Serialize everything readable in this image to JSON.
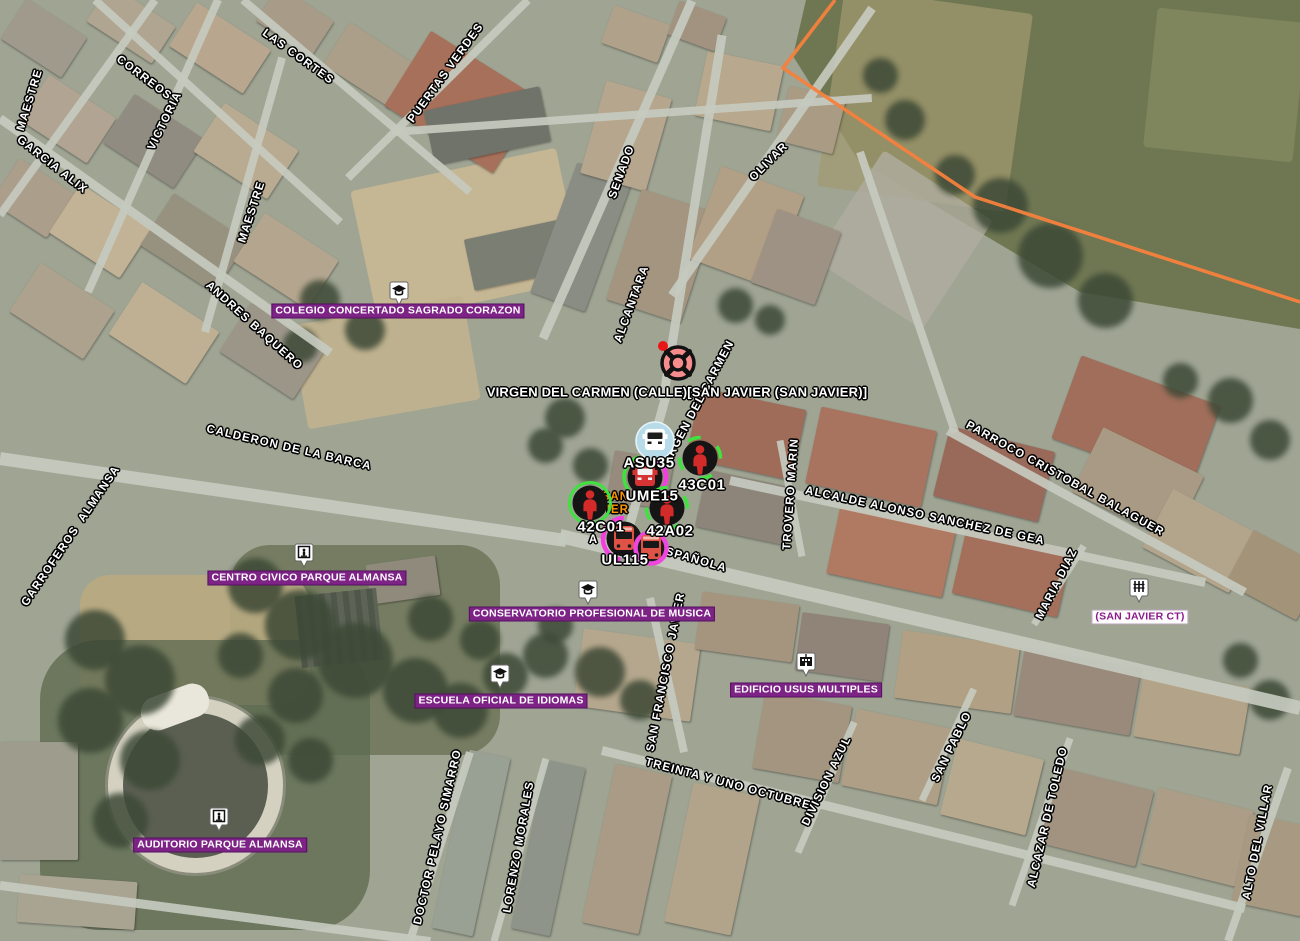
{
  "map": {
    "incident": {
      "label": "VIRGEN DEL CARMEN (CALLE)[SAN JAVIER (SAN JAVIER)]",
      "icon": "crosshair-target-icon",
      "x": 678,
      "y": 363,
      "label_x": 677,
      "label_y": 392
    },
    "street_labels": [
      {
        "text": "MAESTRE",
        "x": 30,
        "y": 100,
        "rot": -73
      },
      {
        "text": "CORREOS",
        "x": 144,
        "y": 78,
        "rot": 37
      },
      {
        "text": "VICTORIA",
        "x": 165,
        "y": 121,
        "rot": -64
      },
      {
        "text": "GARCIA ALIX",
        "x": 52,
        "y": 165,
        "rot": 38
      },
      {
        "text": "LAS CORTES",
        "x": 298,
        "y": 57,
        "rot": 36
      },
      {
        "text": "PUERTAS VERDES",
        "x": 446,
        "y": 73,
        "rot": -54
      },
      {
        "text": "SENADO",
        "x": 622,
        "y": 172,
        "rot": -70
      },
      {
        "text": "OLIVAR",
        "x": 769,
        "y": 162,
        "rot": -45
      },
      {
        "text": "MAESTRE",
        "x": 252,
        "y": 212,
        "rot": -72
      },
      {
        "text": "ANDRES BAQUERO",
        "x": 254,
        "y": 326,
        "rot": 42
      },
      {
        "text": "ALCANTARA",
        "x": 632,
        "y": 304,
        "rot": -70
      },
      {
        "text": "VIRGEN DEL CARMEN",
        "x": 698,
        "y": 404,
        "rot": -62
      },
      {
        "text": "CALDERON DE LA BARCA",
        "x": 289,
        "y": 448,
        "rot": 13
      },
      {
        "text": "GARROFEROS  ALMANSA",
        "x": 71,
        "y": 536,
        "rot": -56
      },
      {
        "text": "PARROCO CRISTOBAL BALAGUER",
        "x": 1065,
        "y": 479,
        "rot": 29
      },
      {
        "text": "TROVERO MARIN",
        "x": 791,
        "y": 494,
        "rot": -86
      },
      {
        "text": "ALCALDE ALONSO SANCHEZ DE GEA",
        "x": 925,
        "y": 516,
        "rot": 12
      },
      {
        "text": "MARIA DIAZ",
        "x": 1057,
        "y": 584,
        "rot": -63
      },
      {
        "text": "ESPAÑOLA",
        "x": 692,
        "y": 559,
        "rot": 16
      },
      {
        "text": "SAN FRANCISCO JAVIER",
        "x": 666,
        "y": 672,
        "rot": -79
      },
      {
        "text": "TREINTA Y UNO OCTUBRE",
        "x": 728,
        "y": 784,
        "rot": 15
      },
      {
        "text": "DOCTOR PELAYO SIMARRO",
        "x": 438,
        "y": 837,
        "rot": -77
      },
      {
        "text": "LORENZO MORALES",
        "x": 519,
        "y": 847,
        "rot": -80
      },
      {
        "text": "DIVISION AZUL",
        "x": 827,
        "y": 781,
        "rot": -64
      },
      {
        "text": "SAN PABLO",
        "x": 952,
        "y": 747,
        "rot": -64
      },
      {
        "text": "ALCAZAR DE TOLEDO",
        "x": 1048,
        "y": 817,
        "rot": -77
      },
      {
        "text": "ALTO DEL VILLAR",
        "x": 1258,
        "y": 842,
        "rot": -79
      }
    ],
    "street_fragments": [
      {
        "text": "A",
        "x": 593,
        "y": 540
      }
    ],
    "occluded_station_label": {
      "lines": [
        "SAN",
        "JAVIER"
      ],
      "visible_fragments": [
        "N",
        "ER"
      ],
      "x": 629,
      "y": 504,
      "color": "#ff9400"
    },
    "pois": [
      {
        "label": "COLEGIO CONCERTADO SAGRADO CORAZON",
        "icon": "graduation-cap-icon",
        "style": "purple",
        "x": 398,
        "y": 311,
        "icon_x": 399,
        "icon_y": 294
      },
      {
        "label": "CENTRO CIVICO PARQUE ALMANSA",
        "icon": "monument-icon",
        "style": "purple",
        "x": 307,
        "y": 578,
        "icon_x": 304,
        "icon_y": 556
      },
      {
        "label": "CONSERVATORIO PROFESIONAL DE MUSICA",
        "icon": "graduation-cap-icon",
        "style": "purple",
        "x": 592,
        "y": 614,
        "icon_x": 588,
        "icon_y": 593
      },
      {
        "label": "ESCUELA OFICIAL DE IDIOMAS",
        "icon": "graduation-cap-icon",
        "style": "purple",
        "x": 501,
        "y": 701,
        "icon_x": 500,
        "icon_y": 677
      },
      {
        "label": "EDIFICIO USUS MULTIPLES",
        "icon": "building-icon",
        "style": "purple",
        "x": 806,
        "y": 690,
        "icon_x": 806,
        "icon_y": 665
      },
      {
        "label": "AUDITORIO PARQUE ALMANSA",
        "icon": "monument-icon",
        "style": "purple",
        "x": 220,
        "y": 845,
        "icon_x": 219,
        "icon_y": 820
      },
      {
        "label": "(SAN JAVIER CT)",
        "icon": "power-tower-icon",
        "style": "light",
        "x": 1140,
        "y": 617,
        "icon_x": 1139,
        "icon_y": 591
      }
    ],
    "units": [
      {
        "id": "ASU35",
        "label": "ASU35",
        "icon": "ambulance-icon",
        "variant": "blue",
        "rings": [],
        "x": 655,
        "y": 441,
        "label_x": 649,
        "label_y": 463
      },
      {
        "id": "UME15",
        "label": "UME15",
        "icon": "ambulance-icon",
        "variant": "black",
        "rings": [
          "magenta-right",
          "green-left"
        ],
        "x": 645,
        "y": 477,
        "label_x": 652,
        "label_y": 496
      },
      {
        "id": "43C01",
        "label": "43C01",
        "icon": "person-icon",
        "variant": "black",
        "rings": [
          "green-brackets"
        ],
        "x": 700,
        "y": 458,
        "label_x": 702,
        "label_y": 485
      },
      {
        "id": "42C01",
        "label": "42C01",
        "icon": "person-icon",
        "variant": "black",
        "rings": [
          "green-ring"
        ],
        "x": 590,
        "y": 503,
        "label_x": 601,
        "label_y": 527
      },
      {
        "id": "42A02",
        "label": "42A02",
        "icon": "person-icon",
        "variant": "black",
        "rings": [
          "green-brackets"
        ],
        "x": 667,
        "y": 508,
        "label_x": 670,
        "label_y": 531
      },
      {
        "id": "UL115",
        "label": "UL115",
        "icon": "bus-icon",
        "variant": "black",
        "rings": [
          "magenta-left"
        ],
        "x": 624,
        "y": 539,
        "label_x": 625,
        "label_y": 560
      },
      {
        "id": "bus-unlabeled",
        "label": "",
        "icon": "bus-icon",
        "variant": "magenta",
        "rings": [],
        "x": 651,
        "y": 548,
        "label_x": 651,
        "label_y": 548
      }
    ],
    "boundary_line": {
      "points": [
        [
          835,
          0
        ],
        [
          783,
          68
        ],
        [
          975,
          197
        ],
        [
          1300,
          302
        ]
      ],
      "color": "#f5813d"
    },
    "colors": {
      "poi_background": "#7d2386",
      "poi_light_text": "#8b1b8b",
      "street_label_text": "#ffffff",
      "unit_label_text": "#ffffff",
      "station_label_text": "#ff9400",
      "boundary_line": "#f5813d",
      "incident_fill": "#f68c8c",
      "incident_dot": "#e81616",
      "unit_marker_fill": "#151515",
      "unit_person_red": "#d32a2a",
      "unit_vehicle_red": "#df5347",
      "asu_circle_blue": "#b7dbe9",
      "ring_green": "#3fe23f",
      "ring_magenta": "#f33fe0"
    }
  }
}
